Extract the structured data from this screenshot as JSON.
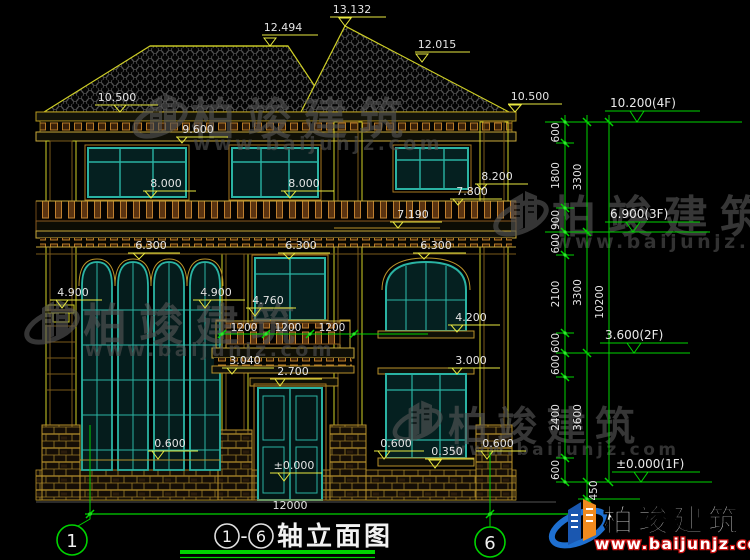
{
  "watermark": {
    "brand": "柏竣建筑",
    "site": "www.baijunjz.com"
  },
  "logo": {
    "brand": "柏竣建筑",
    "site": "www.baijunjz.com"
  },
  "drawing": {
    "title": {
      "axis_start": "1",
      "separator": "-",
      "axis_end": "6",
      "name": "轴立面图"
    },
    "overall_width": "12000",
    "marks": {
      "peak": "13.132",
      "ridge_left": "12.494",
      "slope_right": "12.015",
      "eave_left": "10.500",
      "eave_right": "10.500",
      "cornice_left": "9.600",
      "f3_sill_a": "8.000",
      "f3_sill_b": "8.000",
      "f3_sill_right": "8.200",
      "band_right": "7.800",
      "trim_right": "7.190",
      "head2_a": "6.300",
      "head2_b": "6.300",
      "head2_c": "6.300",
      "capital_a": "4.900",
      "capital_b": "4.900",
      "rail": "4.760",
      "sill2_right": "4.200",
      "slab": "3.040",
      "door_head": "2.700",
      "head1_right": "3.000",
      "sill1_left": "0.600",
      "sill1_ra": "0.600",
      "sill1_mid": "0.350",
      "sill1_rb": "0.600",
      "threshold": "±0.000"
    },
    "levels": [
      {
        "label": "10.200(4F)"
      },
      {
        "label": "6.900(3F)"
      },
      {
        "label": "3.600(2F)"
      },
      {
        "label": "±0.000(1F)"
      }
    ],
    "vdims": {
      "inner": [
        "600",
        "1800",
        "900",
        "600",
        "2100",
        "600",
        "600",
        "2400",
        "600"
      ],
      "mid": [
        "3300",
        "3300",
        "3600"
      ],
      "outer": [
        "10200"
      ],
      "plinth": "450"
    },
    "balcony": [
      "1200",
      "1200",
      "1200"
    ]
  }
}
